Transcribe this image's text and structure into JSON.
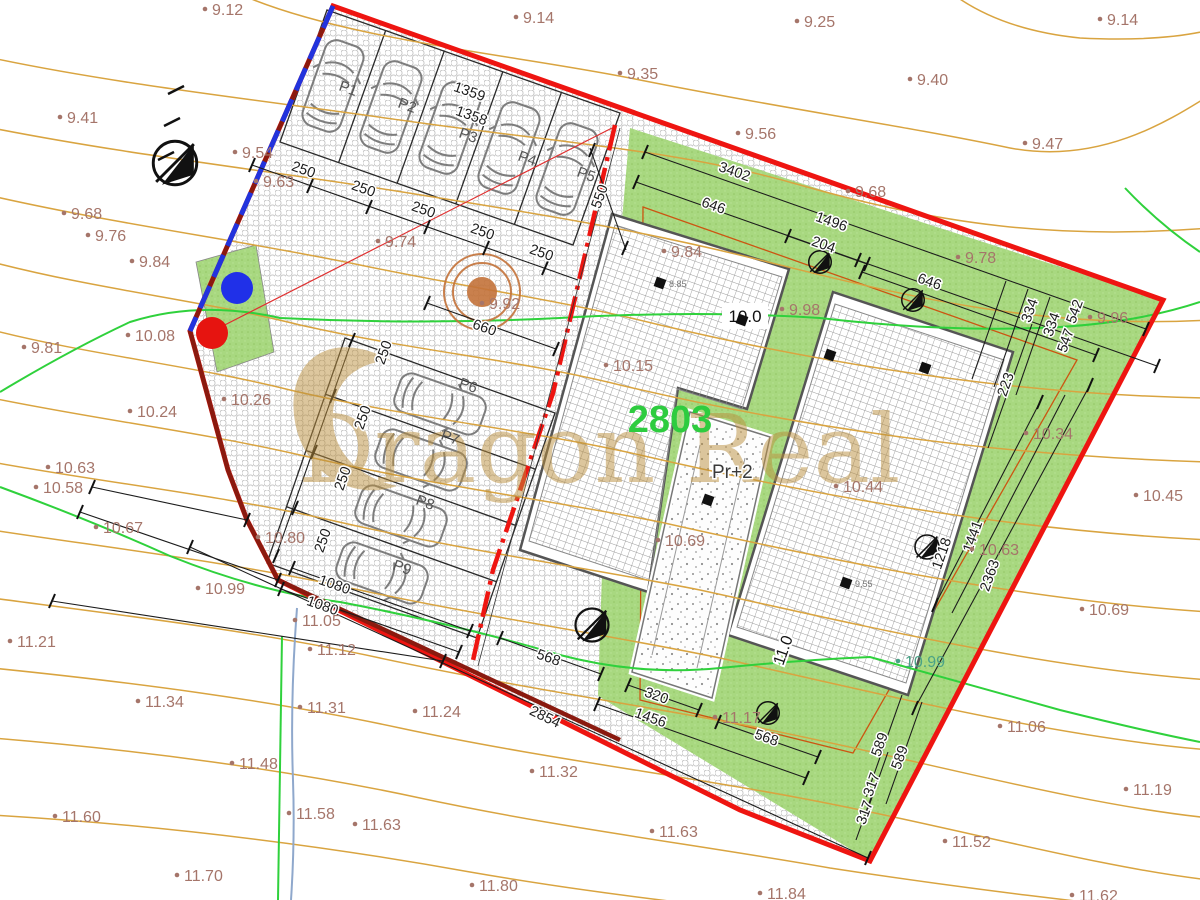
{
  "watermark": {
    "text": "Dragon Real"
  },
  "labels": {
    "parcel_number": "2803",
    "building": "Pr+2",
    "spot_a": "10.0",
    "spot_b": "11.0"
  },
  "colors": {
    "elevation_text": "#a5756a",
    "teal_text": "#4aa287",
    "dim_text": "#1c1c1c",
    "parcel_red": "#ee1511",
    "boundary_maroon": "#8a1a0f",
    "boundary_blue": "#2233dd",
    "green_area": "#a8d880",
    "contour_tan": "#d9a440",
    "contour_green": "#2fd13c",
    "parcel_green_text": "#2ecc3f",
    "watermark_gold": "#bb8f3d",
    "tree_orange": "#c4733a"
  },
  "parking_labels": [
    {
      "v": "P1",
      "x": 338,
      "y": 90
    },
    {
      "v": "P2",
      "x": 397,
      "y": 107
    },
    {
      "v": "P3",
      "x": 458,
      "y": 137
    },
    {
      "v": "P4",
      "x": 517,
      "y": 160
    },
    {
      "v": "P5",
      "x": 576,
      "y": 176
    },
    {
      "v": "P6",
      "x": 458,
      "y": 387
    },
    {
      "v": "P7",
      "x": 440,
      "y": 439
    },
    {
      "v": "P8",
      "x": 415,
      "y": 504
    },
    {
      "v": "P9",
      "x": 392,
      "y": 569
    }
  ],
  "survey_markers": [
    {
      "x": 660,
      "y": 283,
      "label": "8.85"
    },
    {
      "x": 742,
      "y": 320,
      "label": ""
    },
    {
      "x": 830,
      "y": 355,
      "label": ""
    },
    {
      "x": 708,
      "y": 500,
      "label": ""
    },
    {
      "x": 846,
      "y": 583,
      "label": "9.55"
    },
    {
      "x": 925,
      "y": 368,
      "label": ""
    }
  ],
  "elevations": [
    {
      "v": "9.12",
      "x": 205,
      "y": 0
    },
    {
      "v": "9.14",
      "x": 516,
      "y": 8
    },
    {
      "v": "9.25",
      "x": 797,
      "y": 12
    },
    {
      "v": "9.14",
      "x": 1100,
      "y": 10
    },
    {
      "v": "9.35",
      "x": 620,
      "y": 64
    },
    {
      "v": "9.40",
      "x": 910,
      "y": 70
    },
    {
      "v": "9.41",
      "x": 60,
      "y": 108
    },
    {
      "v": "9.56",
      "x": 738,
      "y": 124
    },
    {
      "v": "9.47",
      "x": 1025,
      "y": 134
    },
    {
      "v": "9.54",
      "x": 235,
      "y": 143
    },
    {
      "v": "9.63",
      "x": 256,
      "y": 172
    },
    {
      "v": "9.68",
      "x": 848,
      "y": 182
    },
    {
      "v": "9.68",
      "x": 64,
      "y": 204
    },
    {
      "v": "9.76",
      "x": 88,
      "y": 226
    },
    {
      "v": "9.84",
      "x": 132,
      "y": 252
    },
    {
      "v": "9.74",
      "x": 378,
      "y": 232
    },
    {
      "v": "9.84",
      "x": 664,
      "y": 242
    },
    {
      "v": "9.78",
      "x": 958,
      "y": 248
    },
    {
      "v": "9.92",
      "x": 482,
      "y": 294
    },
    {
      "v": "9.98",
      "x": 782,
      "y": 300
    },
    {
      "v": "9.96",
      "x": 1090,
      "y": 308
    },
    {
      "v": "9.81",
      "x": 24,
      "y": 338
    },
    {
      "v": "10.08",
      "x": 128,
      "y": 326
    },
    {
      "v": "10.26",
      "x": 224,
      "y": 390
    },
    {
      "v": "10.24",
      "x": 130,
      "y": 402
    },
    {
      "v": "10.15",
      "x": 606,
      "y": 356
    },
    {
      "v": "10.34",
      "x": 1026,
      "y": 424
    },
    {
      "v": "10.44",
      "x": 836,
      "y": 477
    },
    {
      "v": "10.45",
      "x": 1136,
      "y": 486
    },
    {
      "v": "10.63",
      "x": 48,
      "y": 458
    },
    {
      "v": "10.58",
      "x": 36,
      "y": 478
    },
    {
      "v": "10.67",
      "x": 96,
      "y": 518
    },
    {
      "v": "10.69",
      "x": 658,
      "y": 531
    },
    {
      "v": "10.63",
      "x": 972,
      "y": 540
    },
    {
      "v": "10.69",
      "x": 1082,
      "y": 600
    },
    {
      "v": "10.80",
      "x": 258,
      "y": 528
    },
    {
      "v": "10.99",
      "x": 198,
      "y": 579
    },
    {
      "v": "10.99",
      "x": 898,
      "y": 652,
      "c": "#4aa287"
    },
    {
      "v": "11.05",
      "x": 295,
      "y": 611
    },
    {
      "v": "11.12",
      "x": 310,
      "y": 640
    },
    {
      "v": "11.21",
      "x": 10,
      "y": 632
    },
    {
      "v": "11.31",
      "x": 300,
      "y": 698
    },
    {
      "v": "11.34",
      "x": 138,
      "y": 692
    },
    {
      "v": "11.24",
      "x": 415,
      "y": 702
    },
    {
      "v": "11.17",
      "x": 715,
      "y": 708
    },
    {
      "v": "11.32",
      "x": 532,
      "y": 762
    },
    {
      "v": "11.06",
      "x": 1000,
      "y": 717
    },
    {
      "v": "11.48",
      "x": 232,
      "y": 754
    },
    {
      "v": "11.19",
      "x": 1126,
      "y": 780
    },
    {
      "v": "11.58",
      "x": 289,
      "y": 804
    },
    {
      "v": "11.63",
      "x": 355,
      "y": 815
    },
    {
      "v": "11.63",
      "x": 652,
      "y": 822
    },
    {
      "v": "11.52",
      "x": 945,
      "y": 832
    },
    {
      "v": "11.60",
      "x": 55,
      "y": 807
    },
    {
      "v": "11.70",
      "x": 177,
      "y": 866
    },
    {
      "v": "11.80",
      "x": 472,
      "y": 876
    },
    {
      "v": "11.84",
      "x": 760,
      "y": 884
    },
    {
      "v": "11.62",
      "x": 1072,
      "y": 886
    }
  ],
  "dimensions": [
    {
      "v": "3402",
      "x": 733,
      "y": 176,
      "r": 19.5
    },
    {
      "v": "646",
      "x": 712,
      "y": 210,
      "r": 19.5
    },
    {
      "v": "1496",
      "x": 830,
      "y": 226,
      "r": 19.5
    },
    {
      "v": "204",
      "x": 822,
      "y": 249,
      "r": 19.5
    },
    {
      "v": "646",
      "x": 928,
      "y": 286,
      "r": 19.5
    },
    {
      "v": "1359",
      "x": 468,
      "y": 96,
      "r": 19.5
    },
    {
      "v": "1358",
      "x": 470,
      "y": 120,
      "r": 19.5
    },
    {
      "v": "550",
      "x": 604,
      "y": 198,
      "r": -70.5
    },
    {
      "v": "250",
      "x": 302,
      "y": 174,
      "r": 19.5
    },
    {
      "v": "250",
      "x": 362,
      "y": 193,
      "r": 19.5
    },
    {
      "v": "250",
      "x": 422,
      "y": 214,
      "r": 19.5
    },
    {
      "v": "250",
      "x": 481,
      "y": 236,
      "r": 19.5
    },
    {
      "v": "250",
      "x": 540,
      "y": 257,
      "r": 19.5
    },
    {
      "v": "660",
      "x": 483,
      "y": 332,
      "r": 19.5
    },
    {
      "v": "250",
      "x": 388,
      "y": 354,
      "r": -70.5
    },
    {
      "v": "250",
      "x": 367,
      "y": 419,
      "r": -70.5
    },
    {
      "v": "250",
      "x": 347,
      "y": 480,
      "r": -70.5
    },
    {
      "v": "250",
      "x": 327,
      "y": 542,
      "r": -70.5
    },
    {
      "v": "1080",
      "x": 333,
      "y": 589,
      "r": 19.5
    },
    {
      "v": "1080",
      "x": 321,
      "y": 610,
      "r": 19.5
    },
    {
      "v": "568",
      "x": 547,
      "y": 662,
      "r": 19.5
    },
    {
      "v": "320",
      "x": 655,
      "y": 700,
      "r": 19.5
    },
    {
      "v": "1456",
      "x": 649,
      "y": 722,
      "r": 19.5
    },
    {
      "v": "568",
      "x": 765,
      "y": 742,
      "r": 19.5
    },
    {
      "v": "2854",
      "x": 543,
      "y": 721,
      "r": 26
    },
    {
      "v": "334",
      "x": 1034,
      "y": 312,
      "r": -70.5
    },
    {
      "v": "334",
      "x": 1056,
      "y": 326,
      "r": -70.5
    },
    {
      "v": "542",
      "x": 1079,
      "y": 313,
      "r": -70.5
    },
    {
      "v": "547",
      "x": 1070,
      "y": 342,
      "r": -70.5
    },
    {
      "v": "223",
      "x": 1010,
      "y": 386,
      "r": -70.5
    },
    {
      "v": "1218",
      "x": 946,
      "y": 555,
      "r": -70.5
    },
    {
      "v": "1441",
      "x": 977,
      "y": 538,
      "r": -70.5
    },
    {
      "v": "2363",
      "x": 994,
      "y": 577,
      "r": -70.5
    },
    {
      "v": "589",
      "x": 884,
      "y": 746,
      "r": -70.5
    },
    {
      "v": "589",
      "x": 904,
      "y": 759,
      "r": -70.5
    },
    {
      "v": "317",
      "x": 876,
      "y": 786,
      "r": -70.5
    },
    {
      "v": "317",
      "x": 869,
      "y": 814,
      "r": -70.5
    }
  ]
}
